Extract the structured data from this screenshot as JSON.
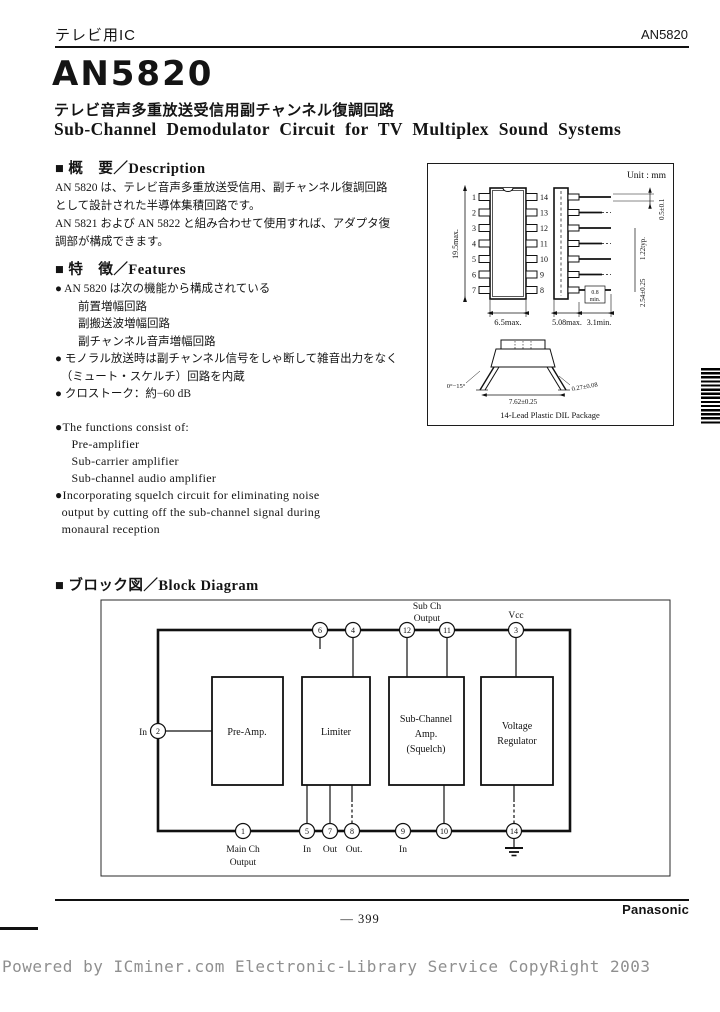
{
  "page": {
    "header_left": "テレビ用IC",
    "header_right": "AN5820",
    "title": "AN5820",
    "subtitle_jp": "テレビ音声多重放送受信用副チャンネル復調回路",
    "subtitle_en": "Sub-Channel Demodulator Circuit for TV Multiplex Sound Systems",
    "page_number": "— 399",
    "brand": "Panasonic",
    "watermark": "Powered by ICminer.com Electronic-Library Service CopyRight 2003"
  },
  "description": {
    "heading": "■ 概　要／Description",
    "lines": [
      "AN 5820 は、テレビ音声多重放送受信用、副チャンネル復調回路",
      "として設計された半導体集積回路です。",
      "AN 5821 および AN 5822 と組み合わせて使用すれば、アダプタ復",
      "調部が構成できます。"
    ]
  },
  "features": {
    "heading": "■ 特　徴／Features",
    "jp_items": [
      "● AN 5820 は次の機能から構成されている",
      "　　前置増幅回路",
      "　　副搬送波増幅回路",
      "　　副チャンネル音声増幅回路",
      "● モノラル放送時は副チャンネル信号をしゃ断して雑音出力をなく",
      "　（ミュート・スケルチ）回路を内蔵",
      "● クロストーク：約−60 dB"
    ],
    "en_items": [
      "●The functions consist of:",
      "     Pre-amplifier",
      "     Sub-carrier amplifier",
      "     Sub-channel audio amplifier",
      "●Incorporating squelch circuit for eliminating noise",
      "  output by cutting off the sub-channel signal during",
      "  monaural reception"
    ]
  },
  "package": {
    "unit": "Unit : mm",
    "caption": "14-Lead Plastic DIL Package",
    "left_pins": [
      "1",
      "2",
      "3",
      "4",
      "5",
      "6",
      "7"
    ],
    "right_pins": [
      "14",
      "13",
      "12",
      "11",
      "10",
      "9",
      "8"
    ],
    "dims": {
      "body_h": "19.5max.",
      "body_w": "6.5max.",
      "seat": "5.08max.",
      "lead_len": "3.1min.",
      "lead_w": "0.5±0.1",
      "typ": "1.22typ.",
      "pitch": "2.54±0.25",
      "min08a": "0.8",
      "min08b": "min.",
      "angle": "0°−15°",
      "row": "7.62±0.25",
      "thick": "0.27±0.08"
    }
  },
  "block_diagram": {
    "heading": "■ ブロック図／Block Diagram",
    "labels": {
      "sub_ch1": "Sub Ch",
      "sub_ch2": "Output",
      "vcc": "Vcc",
      "in_left": "In",
      "main_ch1": "Main Ch",
      "main_ch2": "Output",
      "pin5": "In",
      "pin7": "Out",
      "pin8": "Out.",
      "pin9": "In"
    },
    "blocks": {
      "preamp": "Pre-Amp.",
      "limiter": "Limiter",
      "subch1": "Sub-Channel",
      "subch2": "Amp.",
      "subch3": "(Squelch)",
      "vreg1": "Voltage",
      "vreg2": "Regulator"
    },
    "pins": {
      "p1": "1",
      "p2": "2",
      "p3": "3",
      "p4": "4",
      "p5": "5",
      "p6": "6",
      "p7": "7",
      "p8": "8",
      "p9": "9",
      "p10": "10",
      "p11": "11",
      "p12": "12",
      "p14": "14"
    }
  }
}
